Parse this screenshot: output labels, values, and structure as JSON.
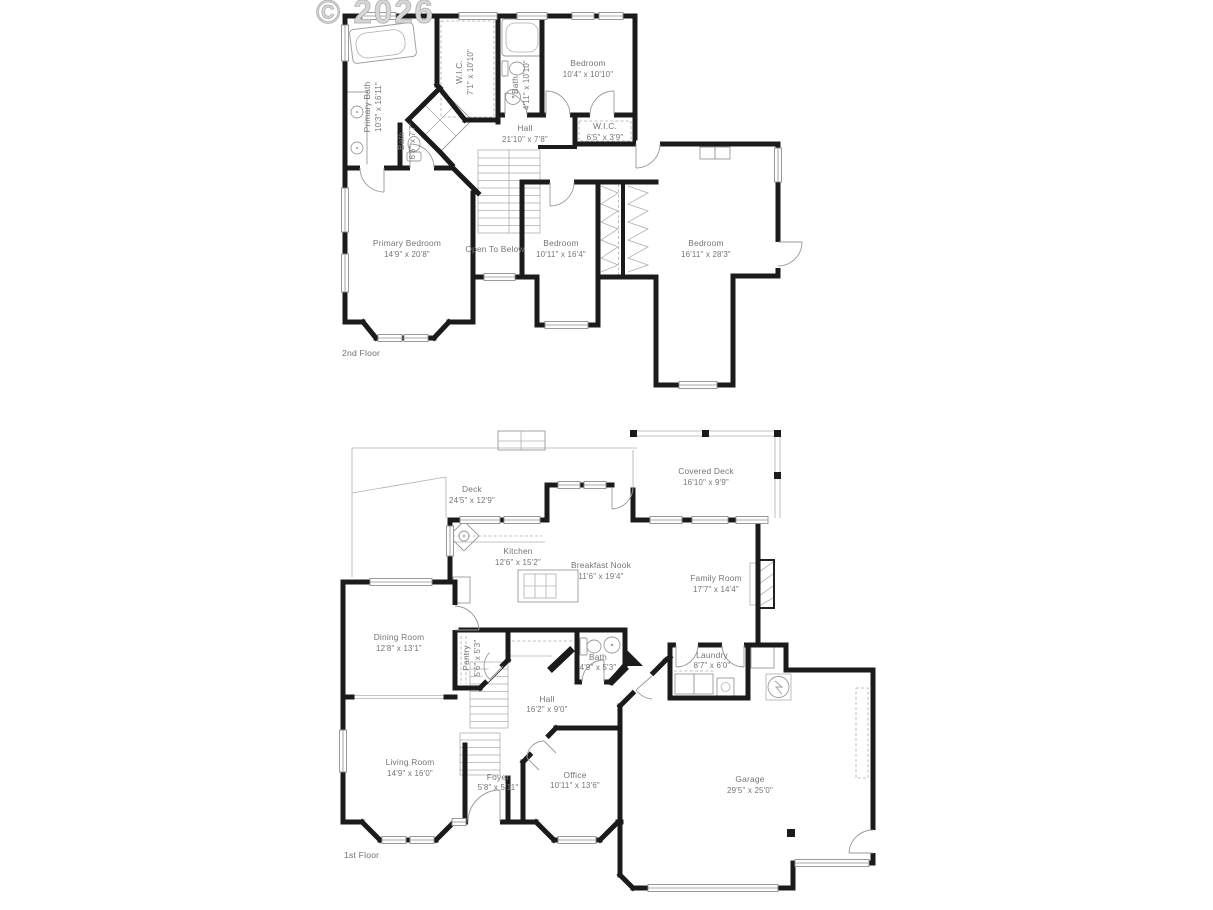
{
  "watermark": "© 2026",
  "colors": {
    "wall": "#1b1b1b",
    "thin_line": "#9a9a9a",
    "label": "#757575",
    "watermark": "#d6d6d6"
  },
  "floors": [
    {
      "caption": "2nd Floor",
      "rooms": [
        {
          "name": "Primary Bath",
          "dims": "10'3\" x 16'11\""
        },
        {
          "name": "W.I.C.",
          "dims": "7'1\" x 10'10\""
        },
        {
          "name": "Bath",
          "dims": "4'11\" x 10'10\""
        },
        {
          "name": "Bedroom",
          "dims": "10'4\" x 10'10\""
        },
        {
          "name": "Bath",
          "dims": "6'5\" x 7'7\""
        },
        {
          "name": "Hall",
          "dims": "21'10\" x 7'8\""
        },
        {
          "name": "W.I.C.",
          "dims": "6'5\" x 3'9\""
        },
        {
          "name": "Primary Bedroom",
          "dims": "14'9\" x 20'8\""
        },
        {
          "name": "Open To Below",
          "dims": ""
        },
        {
          "name": "Bedroom",
          "dims": "10'11\" x 16'4\""
        },
        {
          "name": "Bedroom",
          "dims": "16'11\" x 28'3\""
        }
      ]
    },
    {
      "caption": "1st Floor",
      "rooms": [
        {
          "name": "Deck",
          "dims": "24'5\" x 12'9\""
        },
        {
          "name": "Covered Deck",
          "dims": "16'10\" x 9'9\""
        },
        {
          "name": "Kitchen",
          "dims": "12'6\" x 15'2\""
        },
        {
          "name": "Breakfast Nook",
          "dims": "11'6\" x 19'4\""
        },
        {
          "name": "Family Room",
          "dims": "17'7\" x 14'4\""
        },
        {
          "name": "Dining Room",
          "dims": "12'8\" x 13'1\""
        },
        {
          "name": "Pantry",
          "dims": "5'6\" x 5'3\""
        },
        {
          "name": "Bath",
          "dims": "4'9\" x 5'3\""
        },
        {
          "name": "Laundry",
          "dims": "8'7\" x 6'0\""
        },
        {
          "name": "Hall",
          "dims": "16'2\" x 9'0\""
        },
        {
          "name": "Living Room",
          "dims": "14'9\" x 16'0\""
        },
        {
          "name": "Foyer",
          "dims": "5'8\" x 5'11\""
        },
        {
          "name": "Office",
          "dims": "10'11\" x 13'6\""
        },
        {
          "name": "Garage",
          "dims": "29'5\" x 25'0\""
        }
      ]
    }
  ]
}
